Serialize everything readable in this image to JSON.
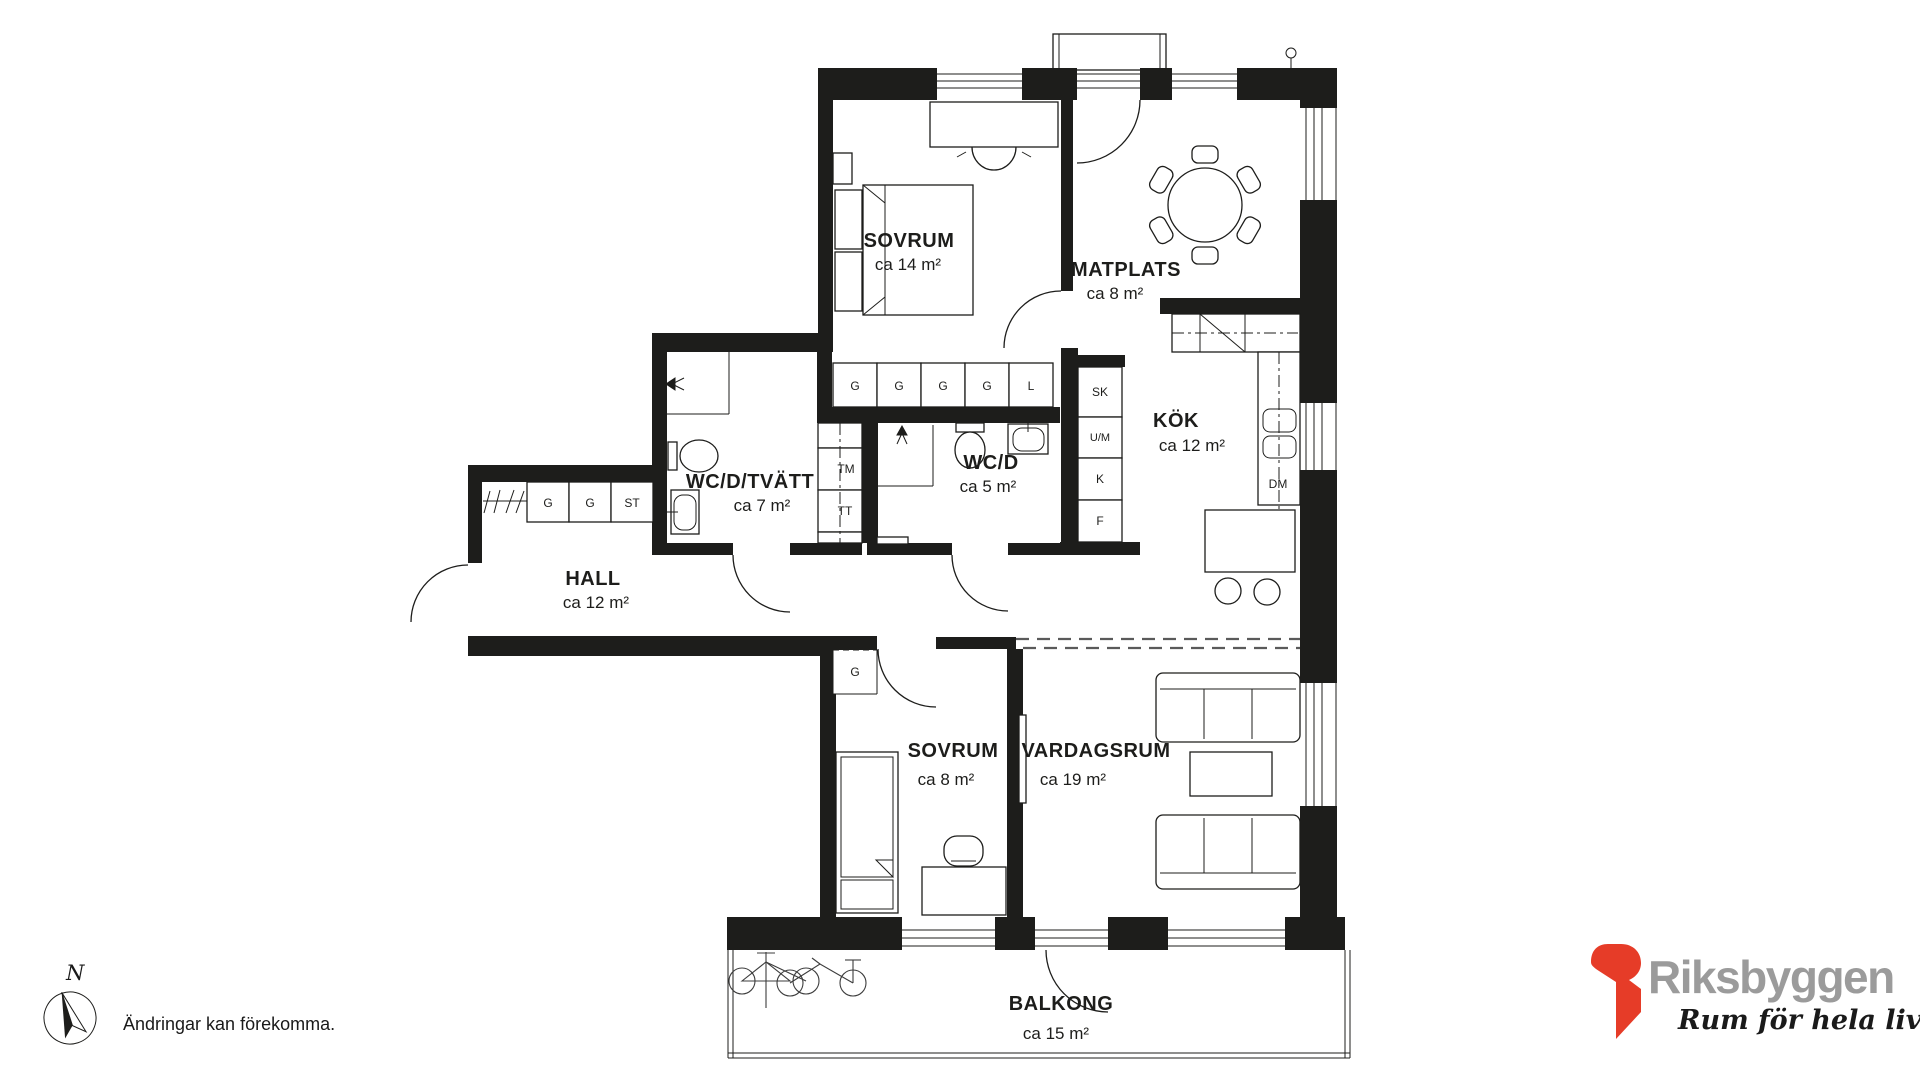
{
  "floorplan": {
    "rooms": {
      "sovrum1": {
        "name": "SOVRUM",
        "area": "ca 14 m²"
      },
      "matplats": {
        "name": "MATPLATS",
        "area": "ca 8 m²"
      },
      "kok": {
        "name": "KÖK",
        "area": "ca 12 m²"
      },
      "wcd_tvatt": {
        "name": "WC/D/TVÄTT",
        "area": "ca 7 m²"
      },
      "wcd": {
        "name": "WC/D",
        "area": "ca 5 m²"
      },
      "hall": {
        "name": "HALL",
        "area": "ca 12 m²"
      },
      "sovrum2": {
        "name": "SOVRUM",
        "area": "ca 8 m²"
      },
      "vardagsrum": {
        "name": "VARDAGSRUM",
        "area": "ca 19 m²"
      },
      "balkong": {
        "name": "BALKONG",
        "area": "ca 15 m²"
      }
    },
    "closets": {
      "bedroom_row": [
        "G",
        "G",
        "G",
        "G",
        "L"
      ],
      "hall_row": [
        "G",
        "G",
        "ST"
      ],
      "kitchen_column": [
        "SK",
        "U/M",
        "K",
        "F"
      ],
      "laundry_column": [
        "TM",
        "TT"
      ],
      "bedroom2_closet": "G",
      "dishwasher": "DM"
    }
  },
  "compass": {
    "label": "N"
  },
  "footer": {
    "disclaimer": "Ändringar kan förekomma."
  },
  "logo": {
    "brand": "Riksbyggen",
    "tagline": "Rum för hela livet"
  },
  "colors": {
    "line": "#1d1d1b",
    "logo_red": "#e63c28",
    "logo_gray": "#9b9b9b"
  }
}
